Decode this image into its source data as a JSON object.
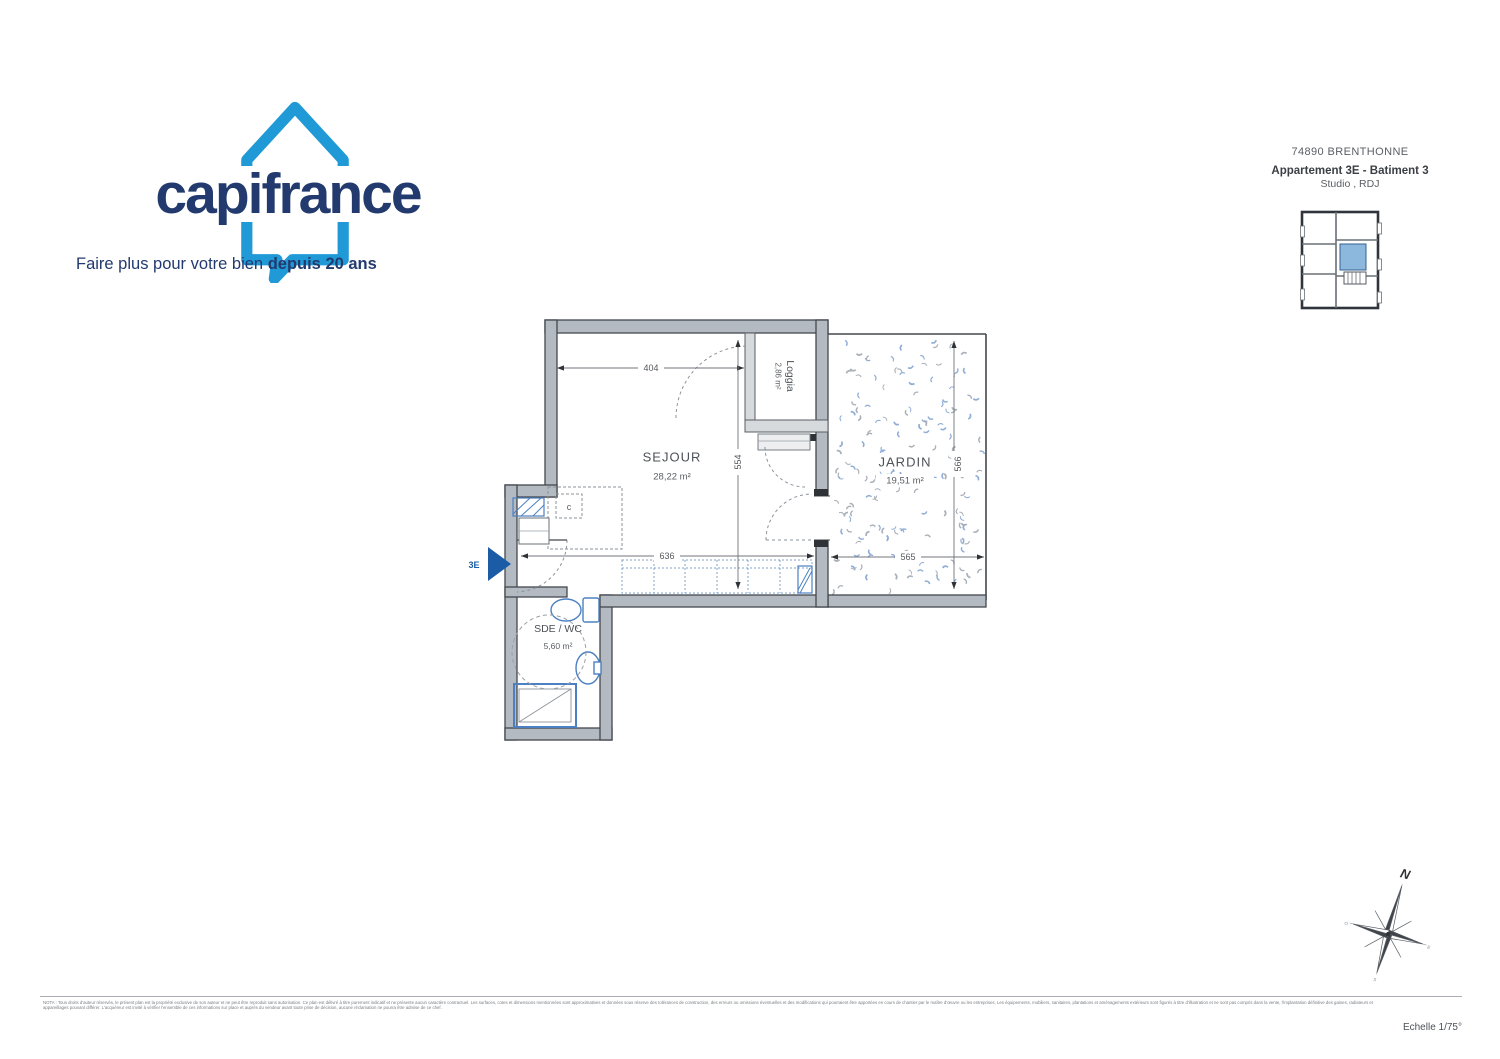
{
  "brand": {
    "logo_text": "capifrance",
    "tagline_regular": "Faire plus pour votre bien ",
    "tagline_bold": "depuis 20 ans",
    "house_color": "#1f9ad6",
    "text_color": "#233a6e"
  },
  "header": {
    "city_line": "74890 BRENTHONNE",
    "property_line": "Appartement 3E - Batiment 3",
    "type_line": "Studio , RDJ"
  },
  "plan": {
    "rooms": {
      "sejour": {
        "name": "SEJOUR",
        "area": "28,22 m²"
      },
      "loggia": {
        "name": "Loggia",
        "area": "2,86 m²"
      },
      "jardin": {
        "name": "JARDIN",
        "area": "19,51 m²"
      },
      "sde": {
        "name": "SDE / WC",
        "area": "5,60 m²"
      }
    },
    "closet_label": "c",
    "unit_label": "3E",
    "dims": {
      "sejour_width": "404",
      "sejour_height": "554",
      "lower_width": "636",
      "jardin_width": "565",
      "jardin_height": "566"
    },
    "colors": {
      "wall": "#b4bac1",
      "wall_line": "#43484e",
      "fixture_blue": "#4c80c2",
      "entry_arrow": "#1c5ca6",
      "keyplan_highlight": "#8cb8dd"
    }
  },
  "compass": {
    "north_label": "N",
    "east_label": "E",
    "south_label": "S",
    "west_label": "O"
  },
  "footer": {
    "disclaimer": "NOTA : Tous droits d'auteur réservés, le présent plan est la propriété exclusive de son auteur et ne peut être reproduit sans autorisation. Ce plan est délivré à titre purement indicatif et ne présente aucun caractère contractuel. Les surfaces, cotes et dimensions mentionnées sont approximatives et données sous réserve des tolérances de construction, des erreurs ou omissions éventuelles et des modifications qui pourraient être apportées en cours de chantier par le maître d'œuvre ou les entreprises. Les équipements, mobiliers, sanitaires, plantations et aménagements extérieurs sont figurés à titre d'illustration et ne sont pas compris dans la vente, l'implantation définitive des gaines, radiateurs et appareillages pouvant différer. L'acquéreur est invité à vérifier l'ensemble de ces informations sur place et auprès du vendeur avant toute prise de décision, aucune réclamation ne pourra être admise de ce chef.",
    "scale": "Echelle 1/75°"
  }
}
